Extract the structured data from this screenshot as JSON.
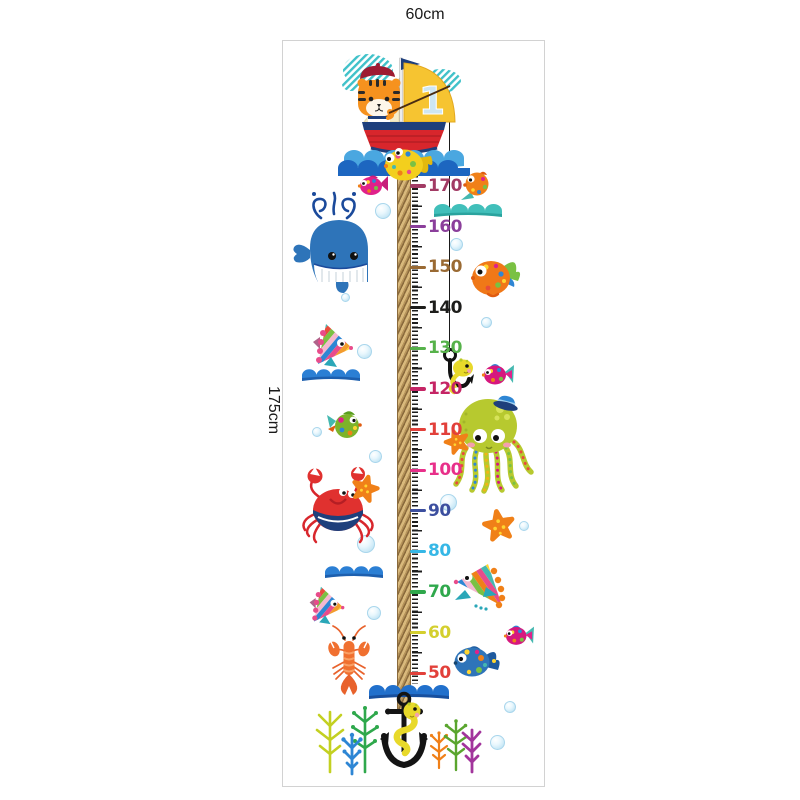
{
  "labels": {
    "width": "60cm",
    "height": "175cm"
  },
  "boat": {
    "sail_number": "1"
  },
  "ruler": {
    "unit": "cm",
    "max": 170,
    "min": 50,
    "step_cm": 10,
    "marks": [
      {
        "label": "170",
        "color": "#a23b64"
      },
      {
        "label": "160",
        "color": "#8b3f9b"
      },
      {
        "label": "150",
        "color": "#9a6a33"
      },
      {
        "label": "140",
        "color": "#1d1d1b"
      },
      {
        "label": "130",
        "color": "#56b24a"
      },
      {
        "label": "120",
        "color": "#c52565"
      },
      {
        "label": "110",
        "color": "#e2403a"
      },
      {
        "label": "100",
        "color": "#e8308a"
      },
      {
        "label": "90",
        "color": "#3c4f9f"
      },
      {
        "label": "80",
        "color": "#36b7e6"
      },
      {
        "label": "70",
        "color": "#2fa84c"
      },
      {
        "label": "60",
        "color": "#d4cf2e"
      },
      {
        "label": "50",
        "color": "#e2403a"
      }
    ],
    "layout": {
      "start_y": 186,
      "step": 40.6
    }
  },
  "bubbles": [
    [
      375,
      203,
      16
    ],
    [
      341,
      293,
      9
    ],
    [
      357,
      344,
      15
    ],
    [
      312,
      427,
      10
    ],
    [
      369,
      450,
      13
    ],
    [
      357,
      535,
      18
    ],
    [
      367,
      606,
      14
    ],
    [
      450,
      238,
      13
    ],
    [
      481,
      317,
      11
    ],
    [
      440,
      494,
      17
    ],
    [
      519,
      521,
      10
    ],
    [
      504,
      701,
      12
    ],
    [
      490,
      735,
      15
    ]
  ],
  "icons": [
    "tiger-in-sailboat",
    "sail-flag",
    "whale",
    "pink-fish",
    "orange-fish",
    "teal-wave",
    "blue-wave",
    "rainbow-fish",
    "green-fish",
    "octopus-with-sailor-hat",
    "starfish",
    "crab",
    "lobster",
    "blue-spotted-fish",
    "fish-hook-with-yellow-fish",
    "anchor-with-yellow-eel",
    "coral-trees",
    "bubble"
  ],
  "colors": {
    "frame_border": "#d2d2d2",
    "rope": "#b5935a",
    "fishing_line": "#1a1a1a",
    "whale_blue": "#2e74b9",
    "boat_red": "#d8262c",
    "boat_navy": "#1e3f7c",
    "sail_yellow": "#f6c431",
    "octopus_green": "#b7c92f",
    "crab_red": "#e0312f",
    "lobster_orange": "#f07030",
    "starfish_orange": "#f08018",
    "wave_blue": "#2b7fd4",
    "wave_teal": "#41bfba",
    "bubble_blue": "#c5e6f5"
  }
}
